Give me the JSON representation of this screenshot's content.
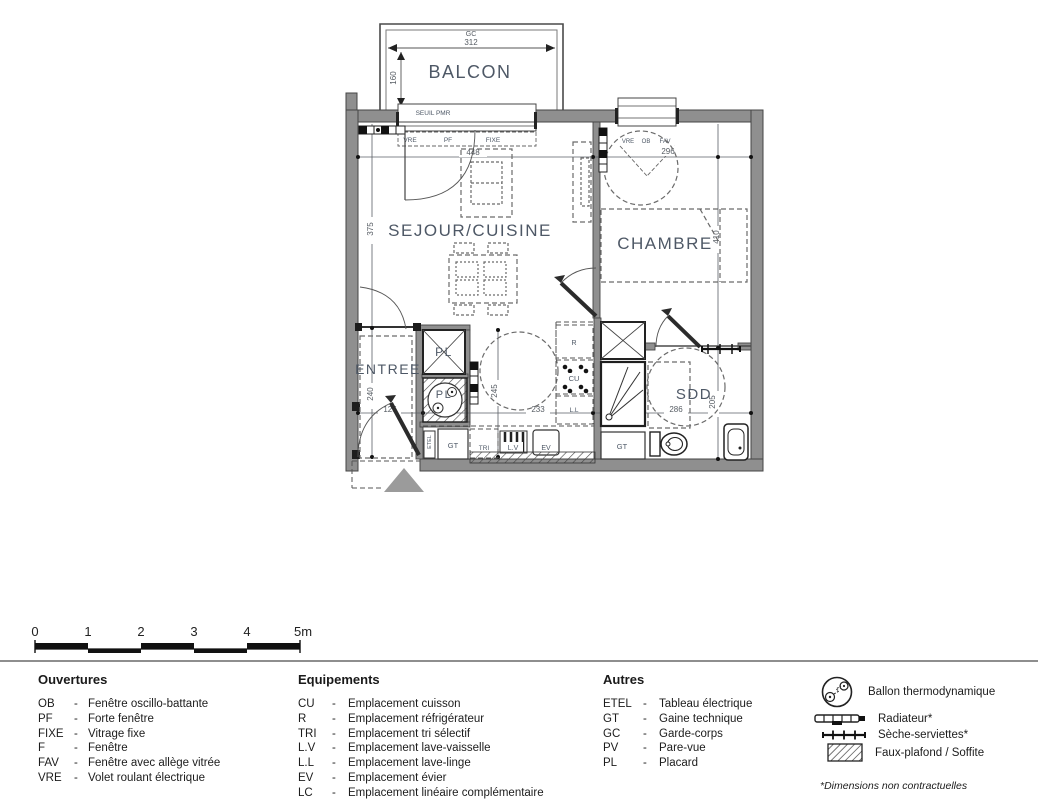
{
  "plan": {
    "rooms": {
      "balcon": "BALCON",
      "sejour": "SEJOUR/CUISINE",
      "chambre": "CHAMBRE",
      "entree": "ENTREE",
      "sdd": "SDD",
      "pl_top": "PL",
      "pl_ballon": "PL"
    },
    "equip": {
      "r": "R",
      "cu": "CU",
      "ll": "L.L",
      "lv": "L.V",
      "tri": "TRI",
      "ev": "EV",
      "gt_left": "GT",
      "gt_right": "GT",
      "etel": "ETEL"
    },
    "openings": {
      "seuil": "SEUIL PMR",
      "vre1": "VRE",
      "pf": "PF",
      "fixe": "FIXE",
      "vre2": "VRE",
      "ob": "OB",
      "fav": "FAV"
    },
    "dims": {
      "gc": "GC",
      "d312": "312",
      "d160": "160",
      "d375": "375",
      "d240": "240",
      "d448": "448",
      "d296": "296",
      "d410": "410",
      "d125": "125",
      "d233": "233",
      "d245": "245",
      "d286": "286",
      "d205": "205"
    }
  },
  "scalebar": {
    "labels": [
      "0",
      "1",
      "2",
      "3",
      "4",
      "5m"
    ]
  },
  "legend": {
    "dash": "-",
    "ouvertures": {
      "title": "Ouvertures",
      "items": [
        {
          "abbr": "OB",
          "label": "Fenêtre oscillo-battante"
        },
        {
          "abbr": "PF",
          "label": "Forte fenêtre"
        },
        {
          "abbr": "FIXE",
          "label": "Vitrage fixe"
        },
        {
          "abbr": "F",
          "label": "Fenêtre"
        },
        {
          "abbr": "FAV",
          "label": "Fenêtre avec allège vitrée"
        },
        {
          "abbr": "VRE",
          "label": "Volet roulant électrique"
        }
      ]
    },
    "equipements": {
      "title": "Equipements",
      "items": [
        {
          "abbr": "CU",
          "label": "Emplacement cuisson"
        },
        {
          "abbr": "R",
          "label": "Emplacement réfrigérateur"
        },
        {
          "abbr": "TRI",
          "label": "Emplacement tri sélectif"
        },
        {
          "abbr": "L.V",
          "label": "Emplacement lave-vaisselle"
        },
        {
          "abbr": "L.L",
          "label": "Emplacement lave-linge"
        },
        {
          "abbr": "EV",
          "label": "Emplacement évier"
        },
        {
          "abbr": "LC",
          "label": "Emplacement linéaire complémentaire"
        }
      ]
    },
    "autres": {
      "title": "Autres",
      "items": [
        {
          "abbr": "ETEL",
          "label": "Tableau électrique"
        },
        {
          "abbr": "GT",
          "label": "Gaine technique"
        },
        {
          "abbr": "GC",
          "label": "Garde-corps"
        },
        {
          "abbr": "PV",
          "label": "Pare-vue"
        },
        {
          "abbr": "PL",
          "label": "Placard"
        }
      ]
    },
    "symbols": {
      "items": [
        {
          "label": "Ballon thermodynamique"
        },
        {
          "label": "Radiateur*"
        },
        {
          "label": "Sèche-serviettes*"
        },
        {
          "label": "Faux-plafond / Soffite"
        }
      ]
    },
    "footnote": "*Dimensions non contractuelles"
  }
}
